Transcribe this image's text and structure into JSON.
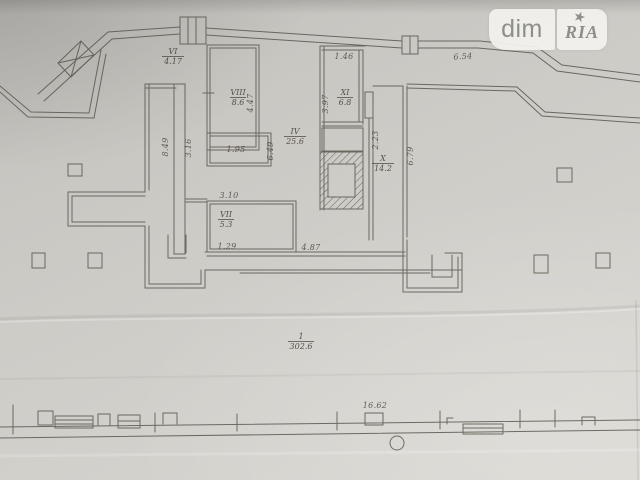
{
  "watermark": {
    "brand_left": "dim",
    "brand_right": "RIA",
    "star_icon": "★"
  },
  "plan": {
    "rooms": [
      {
        "number": "VI",
        "area": "4.17"
      },
      {
        "number": "VIII",
        "area": "8.6"
      },
      {
        "number": "XI",
        "area": "6.8"
      },
      {
        "number": "IV",
        "area": "25.6"
      },
      {
        "number": "X",
        "area": "14.2"
      },
      {
        "number": "VII",
        "area": "5.3"
      },
      {
        "number": "1",
        "area": "302.6"
      }
    ],
    "dimensions": [
      {
        "value": "1.46"
      },
      {
        "value": "3.97"
      },
      {
        "value": "4.47"
      },
      {
        "value": "2.23"
      },
      {
        "value": "6.79"
      },
      {
        "value": "8.49"
      },
      {
        "value": "3.16"
      },
      {
        "value": "1.95"
      },
      {
        "value": "6.49"
      },
      {
        "value": "3.10"
      },
      {
        "value": "1.29"
      },
      {
        "value": "4.87"
      },
      {
        "value": "6.54"
      },
      {
        "value": "16.62"
      }
    ]
  },
  "colors": {
    "paper": "#ceccc7",
    "ink": "#56524b",
    "watermark_bg": "#f2f1ee",
    "watermark_text": "#8b8b89"
  }
}
